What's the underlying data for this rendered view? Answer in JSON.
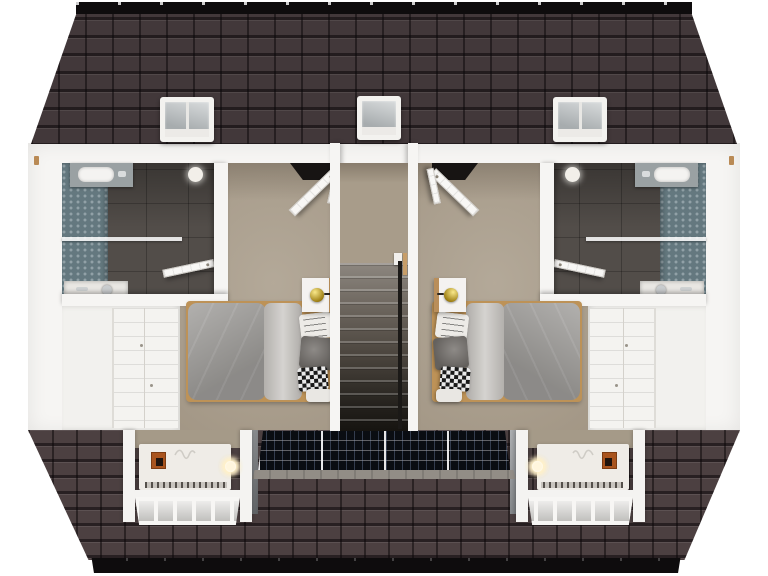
{
  "scene": {
    "title": "3D dollhouse floor plan - upper storey with two mirrored bedroom suites",
    "type": "3d-floor-plan-render",
    "view": "top-down cutaway (roof removed over rooms)",
    "symmetry": "mirrored about the central staircase",
    "visible_text": "none"
  },
  "palette": {
    "background": "#ffffff",
    "roof_tile_top": "#42383a",
    "roof_tile_bottom": "#4c4041",
    "ridge_fascia_black": "#0e0c0d",
    "wall_white": "#f6f5f3",
    "carpet_beige": "#ab9f8d",
    "hall_carpet": "#a89c8a",
    "bathroom_floor_gray": "#524d49",
    "bathroom_tile_teal": "#64787f",
    "stair_dark": "#1b1917",
    "duvet_gray": "#9c9a97",
    "sheet_gray": "#c7c4c0",
    "pillow_dark": "#7a7672",
    "wood_tan": "#bd9257",
    "lamp_gold": "#c2a018",
    "solar_panel_black": "#0a0d12",
    "stone_cheek_gray": "#82868a",
    "glow_warm_white": "#fff6dd",
    "artwork_orange": "#a9541e",
    "roof_window_glass": "#b9bdbf"
  },
  "roof": {
    "top_slope": {
      "ridge_color": "black",
      "roof_window_count": 3,
      "roof_windows": [
        "left",
        "center",
        "right"
      ]
    },
    "bottom_slope": {
      "dormer_bay_count": 2,
      "solar_modules": 4,
      "stone_cheeks": 2
    }
  },
  "staircase": {
    "steps_visible": 13,
    "direction": "descending toward front",
    "handrail_side": "right",
    "landing": "carpeted"
  },
  "rooms": [
    {
      "id": "ensuite-left",
      "type": "bathroom",
      "features": [
        "teal-hex-tiled wall",
        "dark tile floor",
        "washbasin with chrome tap",
        "glass shower screen",
        "shower tray and head",
        "round ceiling light",
        "open door to bedroom"
      ]
    },
    {
      "id": "bedroom-left",
      "type": "bedroom",
      "features": [
        "beige carpet",
        "single bed with gray duvet",
        "folded light-gray sheet",
        "4 pillows (script, dark-gray, checkered, white)",
        "white nightstand with wood edge",
        "gold table lamp",
        "built-in wardrobe",
        "open paneled door to landing"
      ]
    },
    {
      "id": "stair-hall",
      "type": "landing",
      "features": [
        "carpeted landing",
        "straight staircase down",
        "dark handrail",
        "white newel"
      ]
    },
    {
      "id": "bedroom-right",
      "type": "bedroom",
      "mirror_of": "bedroom-left"
    },
    {
      "id": "ensuite-right",
      "type": "bathroom",
      "mirror_of": "ensuite-left"
    },
    {
      "id": "dormer-bay-left",
      "type": "dormer",
      "features": [
        "white heater cabinet",
        "three warm downlights",
        "small orange artwork",
        "wavy wall doodle",
        "vent grille",
        "glazed window band"
      ]
    },
    {
      "id": "dormer-bay-right",
      "type": "dormer",
      "mirror_of": "dormer-bay-left"
    }
  ]
}
